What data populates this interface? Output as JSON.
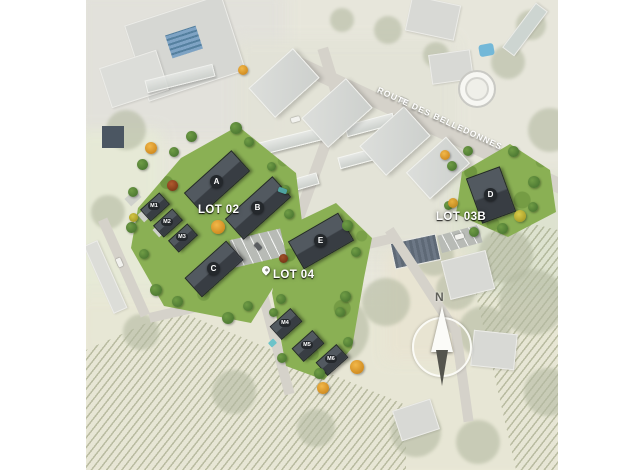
{
  "plan": {
    "street_label": "ROUTE DES BELLEDONNES",
    "north_label": "N",
    "lots": [
      {
        "label": "LOT 02"
      },
      {
        "label": "LOT 03B"
      },
      {
        "label": "LOT 04"
      }
    ],
    "buildings": [
      {
        "label": "A"
      },
      {
        "label": "B"
      },
      {
        "label": "C"
      },
      {
        "label": "D"
      },
      {
        "label": "E"
      }
    ],
    "houses": [
      {
        "label": "M1"
      },
      {
        "label": "M2"
      },
      {
        "label": "M3"
      },
      {
        "label": "M4"
      },
      {
        "label": "M5"
      },
      {
        "label": "M6"
      }
    ],
    "colors": {
      "background": "#ffffff",
      "lawn_green": "#8ab054",
      "roof_dark": "#3d4349",
      "future_building_gray": "#d5d7d4",
      "road_gray": "#d5d2ca",
      "accent_tree_orange": "#e09a2c",
      "label_white": "#ffffff"
    }
  }
}
